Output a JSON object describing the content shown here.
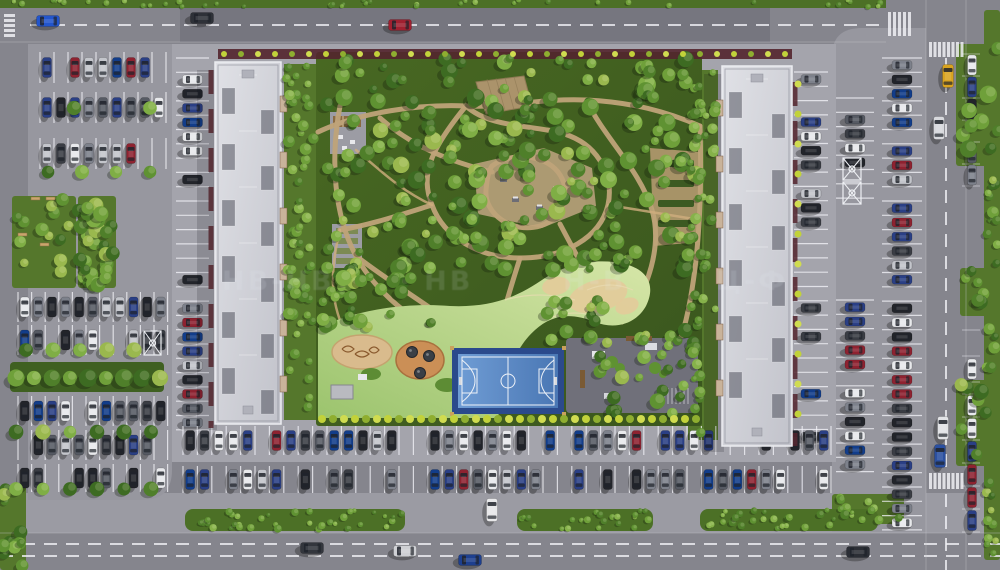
{
  "scene": {
    "width": 1000,
    "height": 570,
    "seed": 1337,
    "watermark": {
      "segments": [
        "НВ-НВ",
        "НВ",
        "Н-В",
        "Ц-Ф"
      ]
    },
    "colors": {
      "road": "#85858d",
      "lot": "#97979f",
      "plate": "#a4a4ac",
      "sidewalk": "#9b9ba3",
      "grass": "#4c7026",
      "lawn": "#55772c",
      "courtyard1": "#44621f",
      "courtyard2": "#3a561e",
      "hedge": "#3f6021",
      "maroon": "#53252e",
      "path": "#bfa379",
      "path_light": "#cfae7e",
      "sand": "#d9bb8d",
      "sand_hill": "#e3cb9a",
      "lawn_light1": "#9cc46e",
      "lawn_light2": "#d6e6a8",
      "roof1": "#dcdde2",
      "roof2": "#c6c7cf",
      "well": "rgba(70,72,84,0.5)",
      "court_outer": "#2b4a8c",
      "court_in1": "#6f9cd4",
      "court_in2": "#4a77b4",
      "fitness": "#70707a",
      "line": "rgba(242,242,247,0.78)",
      "bush_yellow1": "#c2d23a",
      "bush_yellow2": "#8fae30",
      "bush_yellow3": "#d0dc50",
      "tree_palette": [
        "#3d6b22",
        "#4f7f2a",
        "#5f9232",
        "#6fa03a",
        "#7fae45",
        "#9ab84e"
      ],
      "bush_palette": [
        "#4f7f2a",
        "#5f9232",
        "#6fa03a",
        "#86b24a"
      ],
      "car_palette": [
        "#e8e9ec",
        "#22242a",
        "#2a3f85",
        "#7d818b",
        "#3a3d44",
        "#8e2230",
        "#c3c5cb",
        "#123d8a",
        "#565a63",
        "#e8e9ec",
        "#22242a",
        "#2a3f85"
      ]
    },
    "roads": {
      "top": {
        "x": 0,
        "y": 8,
        "w": 1000,
        "h": 34
      },
      "bottom": {
        "x": 0,
        "y": 533,
        "w": 1000,
        "h": 37
      },
      "right": {
        "x": 926,
        "y": 0,
        "w": 40,
        "h": 570
      },
      "left": {
        "x": 0,
        "y": 8,
        "w": 28,
        "h": 470
      }
    },
    "top_grass": {
      "x": 0,
      "y": 0,
      "w": 886,
      "h": 8
    },
    "plates": {
      "complex": {
        "x": 172,
        "y": 44,
        "w": 664,
        "h": 418
      },
      "left_lot": "M28,44 L172,44 L172,470 Q172,500 142,500 L28,500 Z",
      "right_lot": "M832,532 L832,56 Q832,28 862,28 L926,28 L926,532 Z",
      "bottom_sidewalk": {
        "x": 0,
        "y": 493,
        "w": 1000,
        "h": 40
      }
    },
    "dashes": [
      {
        "x1": 30,
        "y1": 25,
        "x2": 880,
        "y2": 25
      },
      {
        "x1": 0,
        "y1": 544,
        "x2": 1000,
        "y2": 544
      },
      {
        "x1": 0,
        "y1": 556,
        "x2": 1000,
        "y2": 556
      },
      {
        "x1": 946,
        "y1": 58,
        "x2": 946,
        "y2": 468
      },
      {
        "x1": 946,
        "y1": 494,
        "x2": 946,
        "y2": 570
      }
    ],
    "edge_lines": [
      {
        "x1": 0,
        "y1": 42,
        "x2": 886,
        "y2": 42
      },
      {
        "x1": 0,
        "y1": 533,
        "x2": 1000,
        "y2": 533
      },
      {
        "x1": 926,
        "y1": 0,
        "x2": 926,
        "y2": 570
      },
      {
        "x1": 966,
        "y1": 0,
        "x2": 966,
        "y2": 570
      }
    ],
    "crosswalks": [
      {
        "x": 4,
        "y": 14,
        "bars": 5,
        "bw": 11,
        "bh": 3,
        "dx": 0,
        "dy": 5
      },
      {
        "x": 888,
        "y": 12,
        "bars": 5,
        "bw": 3,
        "bh": 24,
        "dx": 5,
        "dy": 0
      },
      {
        "x": 929,
        "y": 42,
        "bars": 8,
        "bw": 3,
        "bh": 15,
        "dx": 4.5,
        "dy": 0
      },
      {
        "x": 929,
        "y": 473,
        "bars": 8,
        "bw": 3,
        "bh": 16,
        "dx": 4.5,
        "dy": 0
      }
    ],
    "lawns": [
      {
        "x": 12,
        "y": 196,
        "w": 64,
        "h": 92
      },
      {
        "x": 78,
        "y": 196,
        "w": 38,
        "h": 92
      },
      {
        "x": 0,
        "y": 486,
        "w": 26,
        "h": 84
      },
      {
        "x": 956,
        "y": 44,
        "w": 44,
        "h": 122
      },
      {
        "x": 984,
        "y": 10,
        "w": 16,
        "h": 550
      },
      {
        "x": 960,
        "y": 268,
        "w": 30,
        "h": 48
      },
      {
        "x": 956,
        "y": 380,
        "w": 44,
        "h": 86
      },
      {
        "x": 832,
        "y": 494,
        "w": 72,
        "h": 30
      }
    ],
    "green_strips": [
      {
        "x": 185,
        "y": 509,
        "w": 220,
        "h": 22
      },
      {
        "x": 517,
        "y": 509,
        "w": 136,
        "h": 22
      },
      {
        "x": 700,
        "y": 509,
        "w": 178,
        "h": 22
      }
    ],
    "hedge_block": {
      "x": 10,
      "y": 362,
      "w": 154,
      "h": 30
    },
    "side_planting": [
      {
        "x": 284,
        "y": 64,
        "w": 32,
        "h": 356
      },
      {
        "x": 688,
        "y": 70,
        "w": 30,
        "h": 370
      }
    ],
    "tree_zones": [
      {
        "x": 322,
        "y": 58,
        "w": 374,
        "h": 212,
        "count": 210,
        "rmin": 4,
        "rmax": 9,
        "pal": "tree"
      },
      {
        "x": 322,
        "y": 270,
        "w": 120,
        "h": 58,
        "count": 34,
        "rmin": 4,
        "rmax": 8,
        "pal": "tree"
      },
      {
        "x": 600,
        "y": 330,
        "w": 98,
        "h": 86,
        "count": 26,
        "rmin": 4,
        "rmax": 8,
        "pal": "tree"
      },
      {
        "x": 545,
        "y": 300,
        "w": 70,
        "h": 45,
        "count": 14,
        "rmin": 4,
        "rmax": 7,
        "pal": "tree"
      },
      {
        "x": 286,
        "y": 66,
        "w": 28,
        "h": 350,
        "count": 56,
        "rmin": 3,
        "rmax": 6,
        "pal": "bush"
      },
      {
        "x": 690,
        "y": 72,
        "w": 26,
        "h": 364,
        "count": 52,
        "rmin": 3,
        "rmax": 6,
        "pal": "bush"
      },
      {
        "x": 12,
        "y": 198,
        "w": 62,
        "h": 88,
        "count": 14,
        "rmin": 4,
        "rmax": 7,
        "pal": "tree"
      },
      {
        "x": 78,
        "y": 198,
        "w": 36,
        "h": 88,
        "count": 30,
        "rmin": 5,
        "rmax": 8,
        "pal": "tree"
      },
      {
        "x": 2,
        "y": 488,
        "w": 22,
        "h": 80,
        "count": 12,
        "rmin": 4,
        "rmax": 7,
        "pal": "tree"
      },
      {
        "x": 958,
        "y": 46,
        "w": 40,
        "h": 116,
        "count": 9,
        "rmin": 5,
        "rmax": 9,
        "pal": "tree"
      },
      {
        "x": 986,
        "y": 170,
        "w": 12,
        "h": 200,
        "count": 16,
        "rmin": 3,
        "rmax": 6,
        "pal": "tree"
      },
      {
        "x": 962,
        "y": 270,
        "w": 24,
        "h": 44,
        "count": 6,
        "rmin": 4,
        "rmax": 7,
        "pal": "tree"
      },
      {
        "x": 958,
        "y": 384,
        "w": 40,
        "h": 80,
        "count": 8,
        "rmin": 5,
        "rmax": 8,
        "pal": "tree"
      },
      {
        "x": 986,
        "y": 470,
        "w": 12,
        "h": 96,
        "count": 10,
        "rmin": 3,
        "rmax": 6,
        "pal": "tree"
      },
      {
        "x": 834,
        "y": 496,
        "w": 68,
        "h": 26,
        "count": 9,
        "rmin": 3,
        "rmax": 5,
        "pal": "bush"
      },
      {
        "x": 2,
        "y": 0,
        "w": 880,
        "h": 7,
        "count": 44,
        "rmin": 2,
        "rmax": 3,
        "pal": "bush"
      },
      {
        "x": 187,
        "y": 510,
        "w": 216,
        "h": 19,
        "count": 36,
        "rmin": 2,
        "rmax": 4,
        "pal": "bush"
      },
      {
        "x": 519,
        "y": 510,
        "w": 132,
        "h": 19,
        "count": 22,
        "rmin": 2,
        "rmax": 4,
        "pal": "bush"
      },
      {
        "x": 702,
        "y": 510,
        "w": 174,
        "h": 19,
        "count": 28,
        "rmin": 2,
        "rmax": 4,
        "pal": "bush"
      }
    ],
    "tree_rows": [
      {
        "y": 108,
        "x0": 74,
        "step": 76,
        "count": 2,
        "r": 7
      },
      {
        "y": 172,
        "x0": 48,
        "step": 34,
        "count": 4,
        "r": 7
      },
      {
        "y": 350,
        "x0": 26,
        "step": 27,
        "count": 5,
        "r": 7
      },
      {
        "y": 378,
        "x0": 16,
        "step": 18,
        "count": 9,
        "r": 8
      },
      {
        "y": 432,
        "x0": 16,
        "step": 27,
        "count": 6,
        "r": 7
      },
      {
        "y": 489,
        "x0": 16,
        "step": 27,
        "count": 6,
        "r": 7
      }
    ],
    "parking_rows": [
      {
        "dir": "h",
        "x": 40,
        "y": 52,
        "count": 9,
        "pitch": 14,
        "depth": 31,
        "density": 0.7
      },
      {
        "dir": "h",
        "x": 40,
        "y": 92,
        "count": 9,
        "pitch": 14,
        "depth": 31,
        "density": 0.85
      },
      {
        "dir": "h",
        "x": 40,
        "y": 138,
        "count": 9,
        "pitch": 14,
        "depth": 31,
        "density": 0.8
      },
      {
        "dir": "h",
        "x": 18,
        "y": 292,
        "count": 11,
        "pitch": 13.6,
        "depth": 30,
        "density": 0.85
      },
      {
        "dir": "h",
        "x": 18,
        "y": 325,
        "count": 11,
        "pitch": 13.6,
        "depth": 30,
        "density": 0.8
      },
      {
        "dir": "h",
        "x": 18,
        "y": 396,
        "count": 11,
        "pitch": 13.6,
        "depth": 30,
        "density": 0.8
      },
      {
        "dir": "h",
        "x": 18,
        "y": 430,
        "count": 11,
        "pitch": 13.6,
        "depth": 30,
        "density": 0.7
      },
      {
        "dir": "h",
        "x": 18,
        "y": 464,
        "count": 11,
        "pitch": 13.6,
        "depth": 28,
        "density": 0.55
      },
      {
        "dir": "v",
        "x": 176,
        "y": 58,
        "count": 26,
        "pitch": 14.3,
        "depth": 33,
        "density": 0.5
      },
      {
        "dir": "v",
        "x": 794,
        "y": 72,
        "count": 26,
        "pitch": 14.3,
        "depth": 34,
        "density": 0.55
      },
      {
        "dir": "v",
        "x": 836,
        "y": 98,
        "count": 7,
        "pitch": 14.3,
        "depth": 38,
        "density": 0.7
      },
      {
        "dir": "v",
        "x": 836,
        "y": 300,
        "count": 12,
        "pitch": 14.3,
        "depth": 38,
        "density": 0.75
      },
      {
        "dir": "v",
        "x": 882,
        "y": 58,
        "count": 33,
        "pitch": 14.3,
        "depth": 40,
        "density": 0.85
      },
      {
        "dir": "p",
        "x": 966,
        "y": 54,
        "count": 6,
        "pitch": 22,
        "depth": 22,
        "density": 0.8
      },
      {
        "dir": "p",
        "x": 966,
        "y": 330,
        "count": 2,
        "pitch": 26,
        "depth": 22,
        "density": 0.9
      },
      {
        "dir": "p",
        "x": 966,
        "y": 394,
        "count": 6,
        "pitch": 23,
        "depth": 22,
        "density": 0.8
      },
      {
        "dir": "h",
        "x": 183,
        "y": 426,
        "count": 45,
        "pitch": 14.4,
        "depth": 29,
        "density": 0.8
      },
      {
        "dir": "h",
        "x": 183,
        "y": 466,
        "count": 45,
        "pitch": 14.4,
        "depth": 27,
        "density": 0.72
      }
    ],
    "disabled_stalls": [
      {
        "x": 144,
        "y": 331,
        "w": 17,
        "h": 24
      },
      {
        "x": 843,
        "y": 158,
        "w": 18,
        "h": 22
      },
      {
        "x": 843,
        "y": 182,
        "w": 18,
        "h": 22
      }
    ],
    "benches": [
      [
        31,
        197
      ],
      [
        46,
        197
      ],
      [
        18,
        233
      ],
      [
        40,
        243
      ]
    ],
    "buildings": [
      {
        "x": 215,
        "y": 62,
        "w": 66,
        "h": 362,
        "bump_side": "e"
      },
      {
        "x": 722,
        "y": 66,
        "w": 70,
        "h": 380,
        "bump_side": "w"
      }
    ],
    "maroon_band": {
      "x": 218,
      "y": 49,
      "w": 574,
      "h": 10
    },
    "maroon_lines": [
      {
        "x1": 211,
        "y1": 70,
        "x2": 211,
        "y2": 428
      },
      {
        "x1": 795,
        "y1": 82,
        "x2": 795,
        "y2": 446
      }
    ],
    "yellow_rows": [
      {
        "y": 54,
        "x0": 224,
        "step": 17,
        "count": 34,
        "r": 3
      },
      {
        "y": 419,
        "x0": 322,
        "step": 11,
        "count": 35,
        "r": 4
      }
    ],
    "yellow_cols": [
      {
        "x": 798,
        "y0": 84,
        "step": 30,
        "count": 12,
        "r": 3.5
      }
    ],
    "courtyard": {
      "plate": {
        "x": 316,
        "y": 52,
        "w": 386,
        "h": 374
      },
      "paths_main": [
        "M318,132 C360,112 420,104 466,106 C508,108 540,98 586,100 C632,102 668,112 700,126",
        "M340,106 C330,160 334,215 356,256 C372,286 404,316 444,336",
        "M466,106 C430,150 420,175 432,205 C444,238 480,258 520,258 C564,258 600,238 608,205 C614,178 600,148 570,136 C540,124 492,130 466,106 Z",
        "M492,166 C510,152 544,154 558,172 C572,190 566,218 540,226 C512,234 484,214 486,190 C487,180 488,172 492,166 Z",
        "M586,100 C606,140 640,170 652,210 C662,244 650,290 622,322",
        "M380,118 C414,148 452,162 492,172",
        "M560,224 C580,262 600,300 622,322",
        "M356,256 C390,282 420,300 450,322",
        "M700,126 C702,190 700,260 686,320 C680,346 668,368 652,386",
        "M432,205 C400,215 370,225 340,230",
        "M520,258 C510,290 500,320 496,352"
      ],
      "paths_minor": [
        "M356,150 C380,170 400,190 432,205",
        "M608,205 C640,210 668,215 700,220",
        "M444,336 C470,345 480,348 496,352",
        "M340,230 C330,270 330,300 344,330"
      ],
      "plaza_hex": "M474,164 L544,148 L592,168 L596,206 L542,228 L478,214 Z",
      "plaza_tables": [
        [
          500,
          178
        ],
        [
          524,
          170
        ],
        [
          552,
          188
        ],
        [
          512,
          198
        ],
        [
          536,
          206
        ]
      ],
      "garden_plaza": {
        "path": "M650,148 L700,152 L700,242 L654,246 Z",
        "rows_y": [
          160,
          180,
          200,
          220
        ]
      },
      "small_plaza": {
        "x": 330,
        "y": 112,
        "w": 36,
        "h": 42
      },
      "beds_plaza": {
        "x": 332,
        "y": 224,
        "w": 30,
        "h": 44
      },
      "pavilion": "M476,82 L524,76 L532,106 L486,114 Z",
      "lawn_path": "M318,328 C350,312 400,302 450,306 C495,308 520,295 545,278 C570,262 600,258 625,264 C648,270 656,286 646,306 C636,324 615,330 595,322 C570,312 552,315 535,330 C515,348 505,375 498,418 L318,418 Z",
      "sand_hills": [
        {
          "cx": 598,
          "cy": 296,
          "rx": 30,
          "ry": 16,
          "rot": -15
        },
        {
          "cx": 556,
          "cy": 286,
          "rx": 14,
          "ry": 9,
          "rot": -10
        },
        {
          "cx": 627,
          "cy": 306,
          "rx": 12,
          "ry": 8,
          "rot": -20
        }
      ],
      "sand_pit": {
        "cx": 362,
        "cy": 352,
        "rx": 30,
        "ry": 17
      },
      "trampoline": {
        "cx": 420,
        "cy": 360,
        "rx": 24,
        "ry": 19,
        "holes": [
          [
            412,
            352
          ],
          [
            429,
            356
          ],
          [
            420,
            373
          ]
        ]
      },
      "mounds": [
        [
          447,
          385,
          12,
          7
        ],
        [
          371,
          374,
          10,
          6
        ]
      ],
      "pavilion2": {
        "x": 331,
        "y": 385,
        "w": 22,
        "h": 14
      },
      "court": {
        "x": 452,
        "y": 348,
        "w": 112,
        "h": 66
      },
      "fitness": {
        "x": 566,
        "y": 338,
        "w": 132,
        "h": 75
      }
    },
    "moving_cars": [
      {
        "x": 48,
        "y": 21,
        "vert": false,
        "color": "#2255cc"
      },
      {
        "x": 202,
        "y": 18,
        "vert": false,
        "color": "#2e3138"
      },
      {
        "x": 400,
        "y": 25,
        "vert": false,
        "color": "#a02030"
      },
      {
        "x": 312,
        "y": 548,
        "vert": false,
        "color": "#33363d"
      },
      {
        "x": 405,
        "y": 551,
        "vert": false,
        "color": "#cfd0d4"
      },
      {
        "x": 470,
        "y": 560,
        "vert": false,
        "color": "#1d3f8f"
      },
      {
        "x": 858,
        "y": 552,
        "vert": false,
        "color": "#2b2e35"
      },
      {
        "x": 948,
        "y": 76,
        "vert": true,
        "color": "#d9a31f"
      },
      {
        "x": 939,
        "y": 128,
        "vert": true,
        "color": "#d8d9dd"
      },
      {
        "x": 943,
        "y": 428,
        "vert": true,
        "color": "#e2e3e6"
      },
      {
        "x": 940,
        "y": 456,
        "vert": true,
        "color": "#2a4fa0"
      },
      {
        "x": 492,
        "y": 510,
        "vert": true,
        "color": "#e8e8ea"
      }
    ],
    "shadows": {
      "top_road": {
        "x": 180,
        "y": 8,
        "w": 590,
        "h": 34
      },
      "buildings": [
        {
          "x": 197,
          "y": 70,
          "w": 20,
          "h": 360
        },
        {
          "x": 704,
          "y": 74,
          "w": 20,
          "h": 378
        }
      ]
    }
  }
}
